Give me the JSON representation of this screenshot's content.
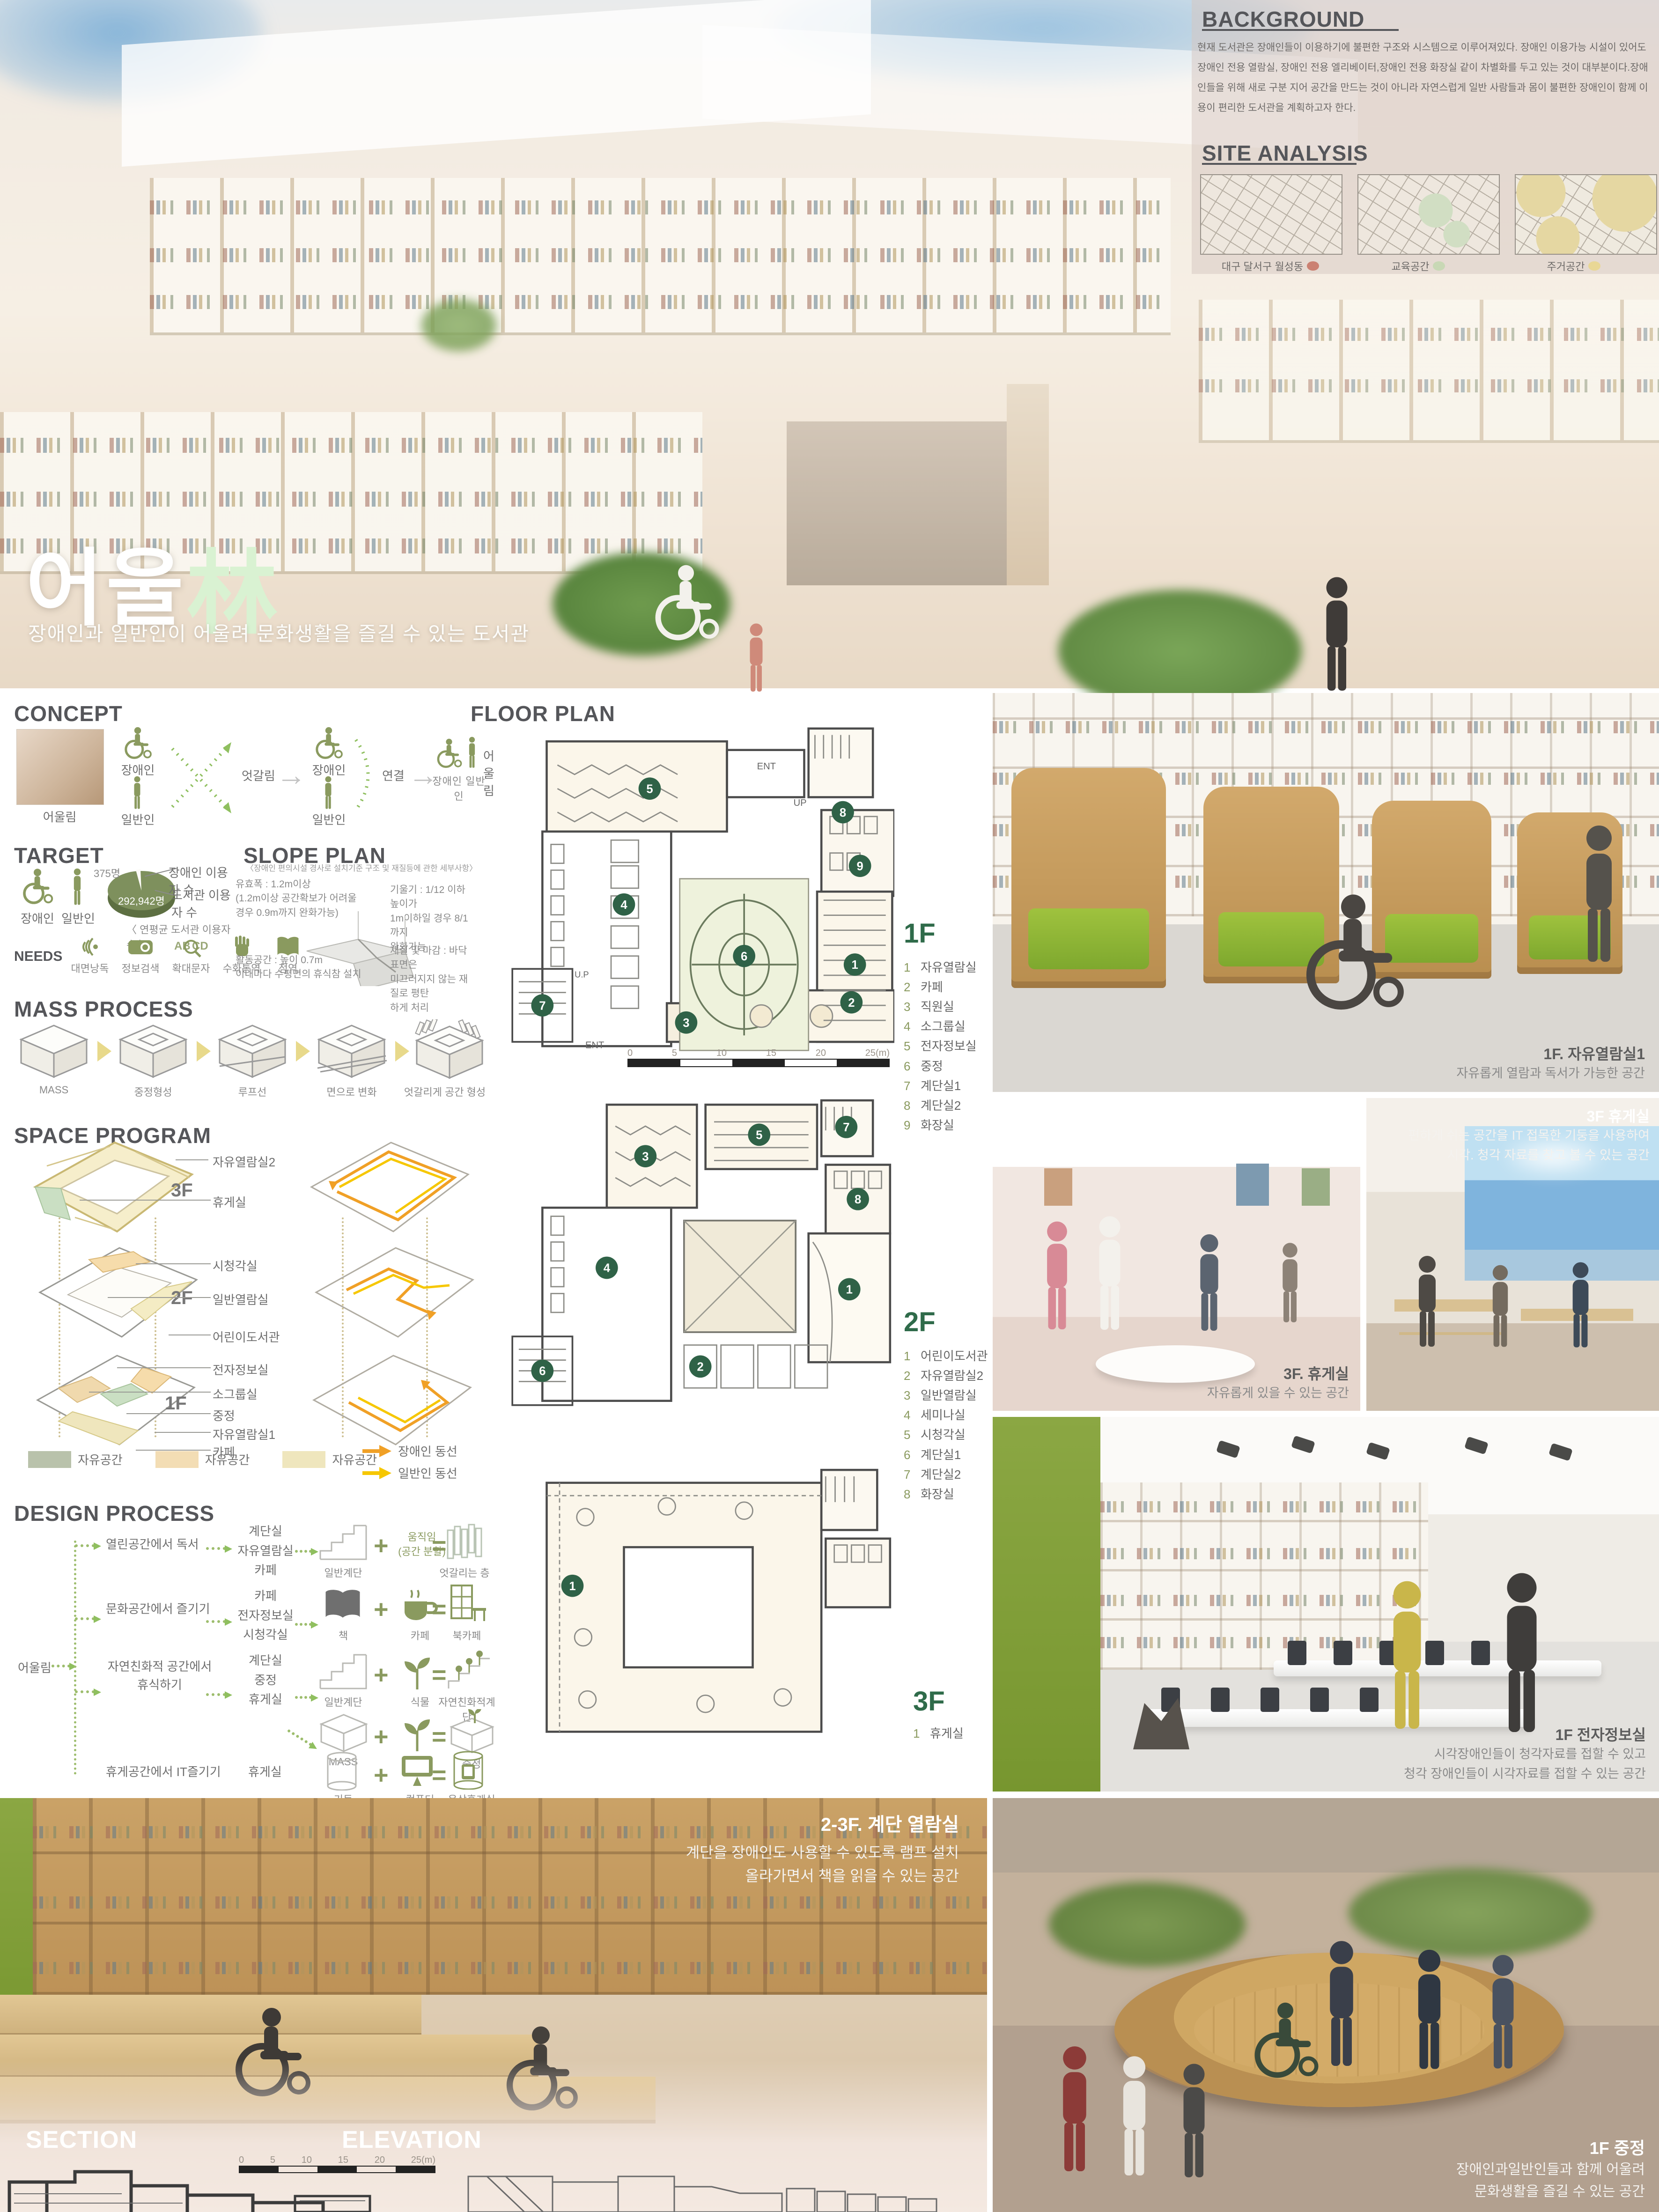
{
  "hero": {
    "title_ko": "어울",
    "title_hanja": "林",
    "subtitle": "장애인과 일반인이 어울려 문화생활을 즐길 수 있는 도서관"
  },
  "background": {
    "title": "BACKGROUND",
    "body": "현재 도서관은 장애인들이 이용하기에 불편한 구조와 시스템으로 이루어져있다. 장애인 이용가능 시설이 있어도 장애인 전용 열람실, 장애인 전용 엘리베이터,장애인 전용 화장실 같이 차별화를 두고 있는 것이 대부분이다.장애인들을 위해 새로 구분 지어 공간을 만드는 것이 아니라 자연스럽게 일반 사람들과 몸이 불편한 장애인이 함께 이용이 편리한 도서관을 계획하고자 한다."
  },
  "site_analysis": {
    "title": "SITE ANALYSIS",
    "maps": [
      {
        "label": "대구 달서구 월성동",
        "dot_color": "#cb8172"
      },
      {
        "label": "교육공간",
        "dot_color": "#c8d8b5"
      },
      {
        "label": "주거공간",
        "dot_color": "#e9d795"
      }
    ]
  },
  "concept": {
    "title": "CONCEPT",
    "photo_label": "어울림",
    "disabled": "장애인",
    "general": "일반인",
    "cross": "엇갈림",
    "connect": "연결",
    "together": "어울림",
    "pair_label": "장애인  일반인"
  },
  "target": {
    "title": "TARGET",
    "disabled": "장애인",
    "general": "일반인",
    "pie_small_value": "375명",
    "pie_small_label": "장애인 이용자 수",
    "pie_big_label": "도서관 이용자 수",
    "pie_big_value": "292,942명",
    "pie_caption": "〈 연평균 도서관 이용자 수 〉",
    "needs_title": "NEEDS",
    "needs": [
      "대면낭독",
      "정보검색",
      "확대문자",
      "수화통역",
      "점역"
    ]
  },
  "slope_plan": {
    "title": "SLOPE PLAN",
    "subtitle": "〈장애인 편의시설 경사로 설치기준 구조 및 재질등에 관한 세부사항〉",
    "note_width": "유효폭 : 1.2m이상\n(1.2m이상 공간확보가 어려울\n경우 0.9m까지 완화가능)",
    "note_slope": "기울기 : 1/12 이하 높이가\n1m이하일 경우 8/1까지\n완화가능",
    "note_activity": "활동공간 : 높이 0.7m\n이내마다 수평면의 휴식참 설치",
    "note_material": "재질 및 마감 : 바닥표면은\n미끄러지지 않는 재질로 평탄\n하게 처리"
  },
  "mass_process": {
    "title": "MASS PROCESS",
    "steps": [
      "MASS",
      "중정형성",
      "루프선",
      "면으로 변화",
      "엇갈리게 공간 형성"
    ]
  },
  "space_program": {
    "title": "SPACE PROGRAM",
    "f3_tag": "3F",
    "f2_tag": "2F",
    "f1_tag": "1F",
    "f3_labels": [
      "자유열람실2",
      "휴게실"
    ],
    "f2_labels": [
      "시청각실",
      "일반열람실",
      "어린이도서관"
    ],
    "f1_labels": [
      "전자정보실",
      "소그룹실",
      "중정",
      "자유열람실1",
      "카페"
    ],
    "legend_spaces": [
      "자유공간",
      "자유공간",
      "자유공간"
    ],
    "legend_flow_disabled": "장애인 동선",
    "legend_flow_general": "일반인 동선"
  },
  "design_process": {
    "title": "DESIGN PROCESS",
    "root": "어울림",
    "b1_need": "열린공간에서 독서",
    "b1_programs": "계단실\n자유열람실\n카페",
    "b1_a": "일반계단",
    "b1_b": "움직임\n(공간 분할)",
    "b1_c": "엇갈리는 층",
    "b2_need": "문화공간에서 즐기기",
    "b2_programs": "카페\n전자정보실\n시청각실",
    "b2_a": "책",
    "b2_b": "카페",
    "b2_c": "북카페",
    "b3_need": "자연친화적 공간에서\n휴식하기",
    "b3_programs": "계단실\n중정\n휴게실",
    "b3_a": "일반계단",
    "b3_b": "식물",
    "b3_c": "자연친화적계단",
    "b3_a2": "MASS",
    "b3_b2": "식물",
    "b3_c2": "중정",
    "b4_need": "휴게공간에서 IT즐기기",
    "b4_programs": "휴게실",
    "b4_a": "기둥",
    "b4_b": "컴퓨터",
    "b4_c": "옥상휴게실"
  },
  "floor_plan": {
    "title": "FLOOR PLAN",
    "ent": "ENT",
    "up": "UP",
    "up2": "U.P",
    "scale_ticks": [
      "0",
      "5",
      "10",
      "15",
      "20",
      "25(m)"
    ],
    "floors": [
      {
        "tag": "1F",
        "rooms": [
          {
            "n": "1",
            "name": "자유열람실"
          },
          {
            "n": "2",
            "name": "카페"
          },
          {
            "n": "3",
            "name": "직원실"
          },
          {
            "n": "4",
            "name": "소그룹실"
          },
          {
            "n": "5",
            "name": "전자정보실"
          },
          {
            "n": "6",
            "name": "중정"
          },
          {
            "n": "7",
            "name": "계단실1"
          },
          {
            "n": "8",
            "name": "계단실2"
          },
          {
            "n": "9",
            "name": "화장실"
          }
        ]
      },
      {
        "tag": "2F",
        "rooms": [
          {
            "n": "1",
            "name": "어린이도서관"
          },
          {
            "n": "2",
            "name": "자유열람실2"
          },
          {
            "n": "3",
            "name": "일반열람실"
          },
          {
            "n": "4",
            "name": "세미나실"
          },
          {
            "n": "5",
            "name": "시청각실"
          },
          {
            "n": "6",
            "name": "계단실1"
          },
          {
            "n": "7",
            "name": "계단실2"
          },
          {
            "n": "8",
            "name": "화장실"
          }
        ]
      },
      {
        "tag": "3F",
        "rooms": [
          {
            "n": "1",
            "name": "휴게실"
          }
        ]
      }
    ]
  },
  "photos": {
    "reading1": {
      "title": "1F. 자유열람실1",
      "caption": "자유롭게 열람과 독서가 가능한 공간"
    },
    "lounge_a": {
      "title": "3F. 휴게실",
      "caption": "자유롭게 있을 수 있는 공간"
    },
    "lounge_b": {
      "title": "3F 휴게실",
      "caption": "편하게 쉬는 공간을 IT 접목한 기둥을 사용하여\n시각. 청각 자료를 찾고 볼 수 있는 공간"
    },
    "digital": {
      "title": "1F 전자정보실",
      "caption": "시각장애인들이 청각자료를 접할 수 있고\n청각 장애인들이 시각자료를 접할 수 있는 공간"
    },
    "stair": {
      "title": "2-3F. 계단 열람실",
      "caption": "계단을 장애인도 사용할 수 있도록 램프 설치\n올라가면서 책을 읽을 수 있는 공간"
    },
    "courtyard": {
      "title": "1F 중정",
      "caption": "장애인과일반인들과 함께 어울려\n문화생활을 즐길 수 있는 공간"
    }
  },
  "drawings": {
    "section_title": "SECTION",
    "elevation_title": "ELEVATION",
    "scale_ticks": [
      "0",
      "5",
      "10",
      "15",
      "20",
      "25(m)"
    ]
  }
}
